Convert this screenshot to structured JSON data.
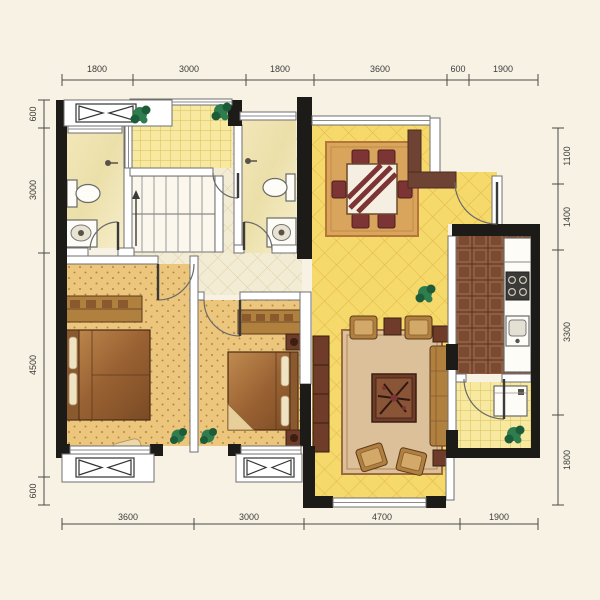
{
  "document": {
    "type": "apartment floor plan",
    "units": "mm",
    "style": "color architectural marketing plan"
  },
  "palette": {
    "background": "#f7f2e3",
    "wall_black": "#1d1b18",
    "wall_brown": "#6e4334",
    "living_floor": "#f6d96b",
    "hall_floor": "#f3ecd4",
    "balcony_floor": "#f8e9a0",
    "bathroom_floor": "#f1e5b5",
    "bedroom_floor": "#ecc67c",
    "kitchen_floor": "#7b4b31",
    "rug_dining": "#d9a45c",
    "rug_living": "#dcc09a",
    "chair_maroon": "#7c3434",
    "plant_green": "#2f7d4f"
  },
  "dimensions": {
    "top": [
      "1800",
      "3000",
      "1800",
      "3600",
      "600",
      "1900"
    ],
    "bottom": [
      "3600",
      "3000",
      "4700",
      "1900"
    ],
    "left": [
      "600",
      "3000",
      "4500",
      "600"
    ],
    "right": [
      "1100",
      "1400",
      "3300",
      "1800"
    ]
  },
  "rooms": [
    {
      "name": "top balcony",
      "fixtures": [
        "plants",
        "railing window"
      ]
    },
    {
      "name": "bathroom 1",
      "fixtures": [
        "toilet",
        "washbasin",
        "shower head",
        "door"
      ]
    },
    {
      "name": "staircase",
      "fixtures": [
        "u-shaped stair",
        "direction arrow"
      ]
    },
    {
      "name": "bathroom 2",
      "fixtures": [
        "toilet",
        "washbasin",
        "shower head",
        "window",
        "door"
      ]
    },
    {
      "name": "dining area",
      "fixtures": [
        "dining table",
        "six chairs",
        "rug",
        "window"
      ]
    },
    {
      "name": "entry",
      "fixtures": [
        "entry door",
        "feature wall"
      ]
    },
    {
      "name": "kitchen",
      "fixtures": [
        "counter",
        "cooktop",
        "sink"
      ]
    },
    {
      "name": "utility balcony",
      "fixtures": [
        "washing machine",
        "plant",
        "door"
      ]
    },
    {
      "name": "living room",
      "fixtures": [
        "sofa set",
        "coffee table",
        "tv cabinet",
        "rug",
        "window"
      ]
    },
    {
      "name": "master bedroom",
      "fixtures": [
        "double bed",
        "wardrobe",
        "bench",
        "bay window with AC symbol"
      ]
    },
    {
      "name": "bedroom 2",
      "fixtures": [
        "double bed",
        "wardrobe",
        "nightstands",
        "bay window with AC symbol"
      ]
    },
    {
      "name": "hallway",
      "fixtures": []
    }
  ],
  "ac_symbols_count": "3"
}
